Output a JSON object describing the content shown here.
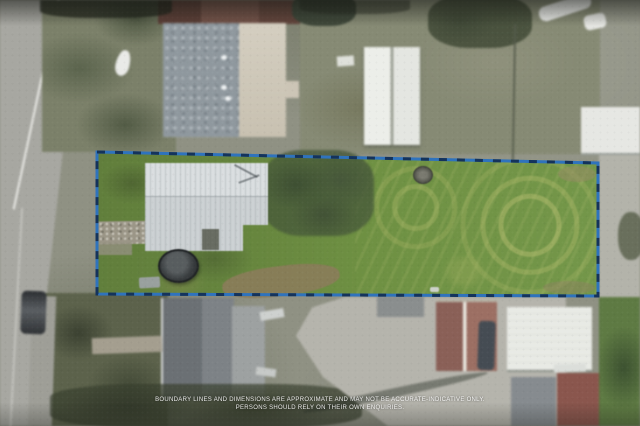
{
  "disclaimer": {
    "line1": "BOUNDARY LINES AND DIMENSIONS ARE APPROXIMATE AND MAY NOT BE ACCURATE-INDICATIVE ONLY.",
    "line2": "PERSONS SHOULD RELY ON THEIR OWN ENQUIRIES."
  },
  "boundary": {
    "points": "97,152 598,163 598,296 97,294",
    "line_color": "#2f73bd",
    "dash_color": "#14335c",
    "dash_pattern": "8 10"
  },
  "palette": {
    "lot_lawn_green": "#6f9143",
    "outside_ground": "#8f9183",
    "road_gray": "#a7a7a1",
    "subject_house_roof": "#d3d8da",
    "neighbor_roof_speckled": "#8f989e",
    "neighbor_roof_beige": "#cfc9ba",
    "white_shed": "#e8eae5",
    "red_roof": "#8a6057",
    "driveway_concrete": "#b5b4ac",
    "trampoline_dark": "#2c2f31"
  }
}
